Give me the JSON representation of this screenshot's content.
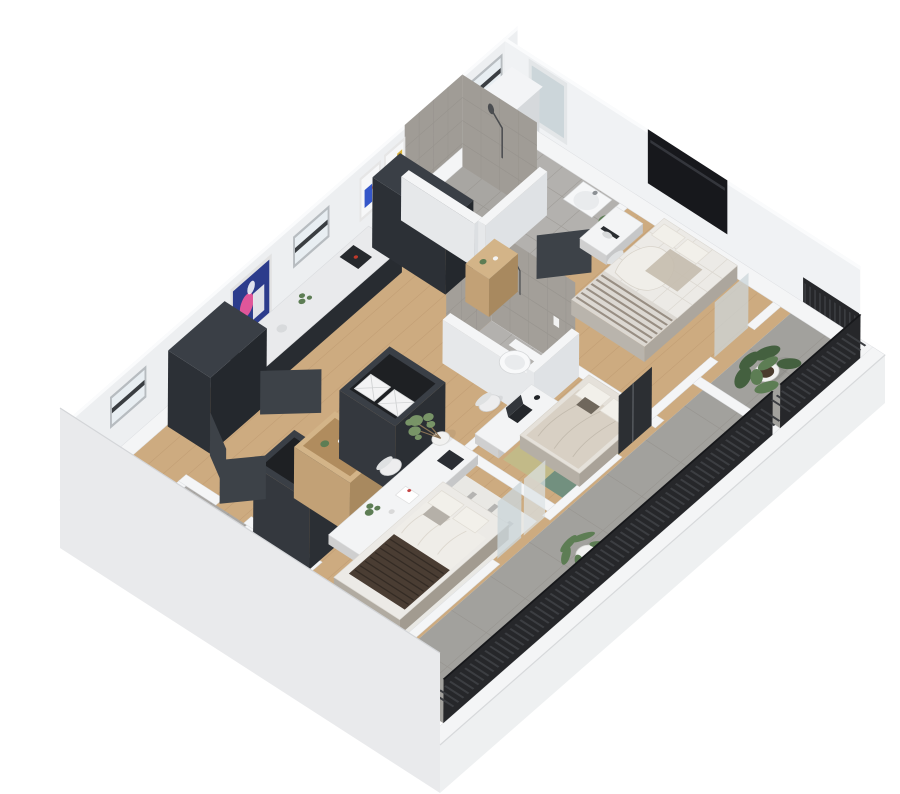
{
  "meta": {
    "description": "3D isometric dollhouse floor-plan rendering of an apartment",
    "background": "#ffffff"
  },
  "colors": {
    "wall_top": "#f4f5f6",
    "wall_face": "#edeff1",
    "wall_face_right": "#f0f2f4",
    "band_sw": "#e9eaec",
    "band_se": "#eef0f1",
    "wood_floor": "#cdab80",
    "tile_floor": "#b3b1ae",
    "tile_shower_floor": "#a8a6a2",
    "tile_wc": "#aaa8a5",
    "tile_wall": "#a09c96",
    "tile_wall_b": "#a39f99",
    "balcony_floor": "#a2a19d",
    "rug_stripe_base": "#e9e8e4",
    "rug_stripe": "#acacaa",
    "rug_green": "#c2ba88",
    "rug_teal": "#72907f",
    "rug_sage": "#9aa98c",
    "rug_yellow": "#d3c688",
    "dark_cabinet": "#3a3f46",
    "counter_top": "#e9eaec",
    "cooktop": "#151721",
    "hob_ring": "#5866d6",
    "door_leaf": "#3d4248",
    "linen": "#eceae6",
    "linen_frame": "#dcd8d2",
    "duvet_greige": "#d8d0c4",
    "pillow": "#f2f0ea",
    "throw_dark": "#4a3d33",
    "glass": "#ccd6da",
    "glass_light": "#dbe2e5",
    "tv_screen": "#17181c",
    "railing": "#26272a",
    "railing_slat": "#3c3e42",
    "plant_dark": "#44603f",
    "plant_mid": "#5d7d54",
    "plant_light": "#7d9a6a",
    "pot_white": "#f1f1f0",
    "pot_brown": "#6b5138",
    "wood_accent": "#d3b488",
    "chair": "#ededee",
    "chair_back": "#dfe1e2",
    "art_navy": "#2c3c8c",
    "art_pink": "#e0569a",
    "art_yellow": "#d9b23a",
    "art_blue": "#3557c9",
    "art_teal": "#4fb3ae",
    "mirror": "#ccd6da"
  },
  "scene": {
    "view": "isometric-dollhouse",
    "rooms": [
      {
        "id": "bathroom-main",
        "label": "bathroom-with-walk-in-shower",
        "items": [
          "tiled-shower",
          "shower-head",
          "washbasin",
          "mirror-niche",
          "potted-plant",
          "window"
        ]
      },
      {
        "id": "bedroom-right",
        "label": "bedroom-with-tv",
        "items": [
          "slatted-double-bed",
          "wall-mounted-tv",
          "desk",
          "chair",
          "balcony-door"
        ]
      },
      {
        "id": "kitchen",
        "label": "open-kitchen",
        "items": [
          "wall-counter",
          "coffee-machine",
          "tall-cabinets",
          "island-counter",
          "induction-cooktop",
          "kitchen-sink"
        ]
      },
      {
        "id": "shower-room-2",
        "label": "second-shower-room",
        "items": [
          "wall-hung-toilet",
          "shower-head",
          "tiled-walls",
          "wood-shelf"
        ]
      },
      {
        "id": "bedroom-middle",
        "label": "bedroom-with-color-rug",
        "items": [
          "double-bed",
          "patch-rug",
          "desk",
          "laptop",
          "chair",
          "olive-tree"
        ]
      },
      {
        "id": "bedroom-lower",
        "label": "bedroom-with-striped-rug",
        "items": [
          "double-bed-dark-throw",
          "striped-rug",
          "open-wardrobe-boxes",
          "wood-shelf-unit",
          "long-desk",
          "chair",
          "storage-bins"
        ]
      },
      {
        "id": "wc",
        "label": "guest-wc",
        "items": [
          "wall-hung-toilet",
          "shower-tray"
        ]
      },
      {
        "id": "hallway",
        "label": "hallway",
        "items": [
          "open-doors",
          "tall-wardrobe",
          "art-posters",
          "windows"
        ]
      },
      {
        "id": "balcony-long",
        "label": "long-balcony",
        "items": [
          "slat-railing",
          "potted-plant",
          "concrete-tiles"
        ]
      },
      {
        "id": "balcony-corner",
        "label": "corner-balcony",
        "items": [
          "slat-railing",
          "monstera-plant"
        ]
      }
    ]
  }
}
